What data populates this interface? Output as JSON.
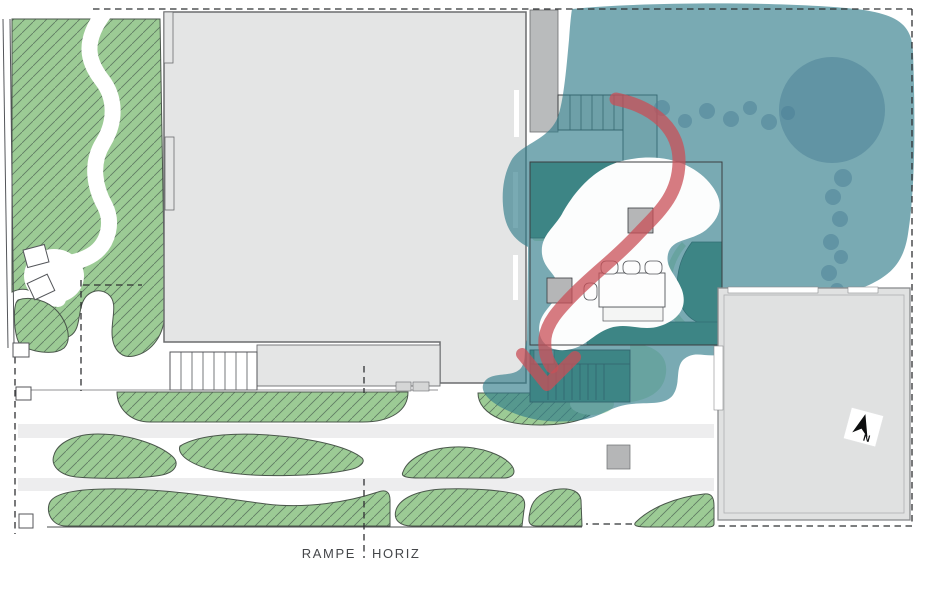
{
  "plan": {
    "labels": {
      "ramp_left": "RAMPE",
      "ramp_right": "HORIZ",
      "north": "N"
    },
    "colors": {
      "lawn_green": "#9ccb95",
      "hatch_line": "#5f7a62",
      "bed_outline": "#4a574b",
      "planter_green": "#55947c",
      "light_green": "#cdeac9",
      "canopy_teal": "#317c8a",
      "canopy_shadow": "#4a7d96",
      "route_red": "#c94f57",
      "building_gray": "#e4e5e5",
      "annex_gray": "#b9bbbc",
      "neighbor_gray": "#e0e1e1",
      "column_gray": "#b5b6b7",
      "sidewalk_gray": "#ededee",
      "line_dark": "#2f3133"
    }
  }
}
